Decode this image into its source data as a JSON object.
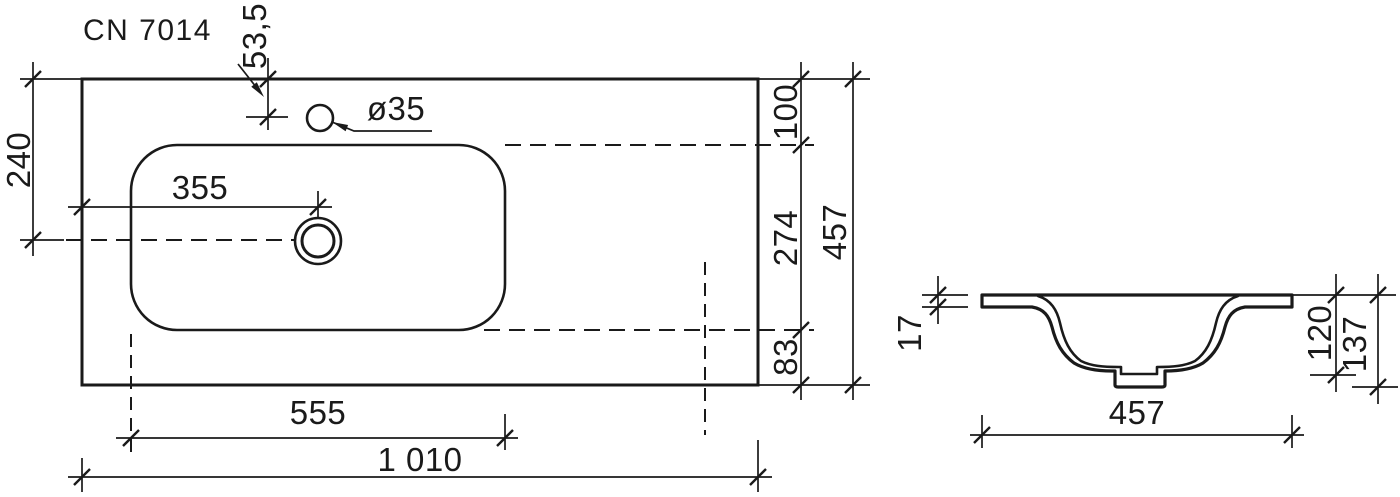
{
  "drawing": {
    "title": "CN 7014",
    "line_color": "#1a1a1a",
    "text_color": "#1a1a1a",
    "background_color": "#ffffff"
  },
  "top_view": {
    "name": "washbasin-plan-view",
    "dim_faucet_hole_from_top": "53,5",
    "dim_center_from_top": "240",
    "dim_faucet_hole_diameter": "ø35",
    "dim_drain_from_left": "355",
    "dim_top_edge_to_basin": "100",
    "dim_basin_depth": "274",
    "dim_total_depth": "457",
    "dim_basin_to_bottom_edge": "83",
    "dim_basin_width": "555",
    "dim_total_width": "1 010"
  },
  "side_view": {
    "name": "washbasin-section-view",
    "dim_rim_thickness": "17",
    "dim_inner_depth": "120",
    "dim_total_height": "137",
    "dim_total_depth": "457"
  }
}
